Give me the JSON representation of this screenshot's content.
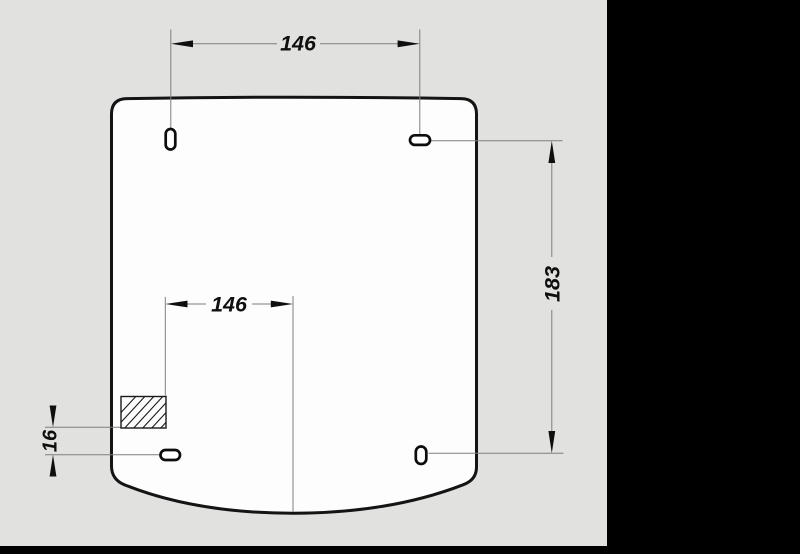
{
  "drawing": {
    "colors": {
      "background": "#e1e1e0",
      "frame": "#000000",
      "panel_fill": "#fdfdfd",
      "outline": "#141414",
      "thin_line": "#7f7f7f",
      "text": "#0f0f0f"
    },
    "dimensions": {
      "top_width": {
        "label": "146"
      },
      "slot_to_center": {
        "label": "146"
      },
      "right_height": {
        "label": "183"
      },
      "hatch_offset": {
        "label": "16"
      }
    }
  }
}
